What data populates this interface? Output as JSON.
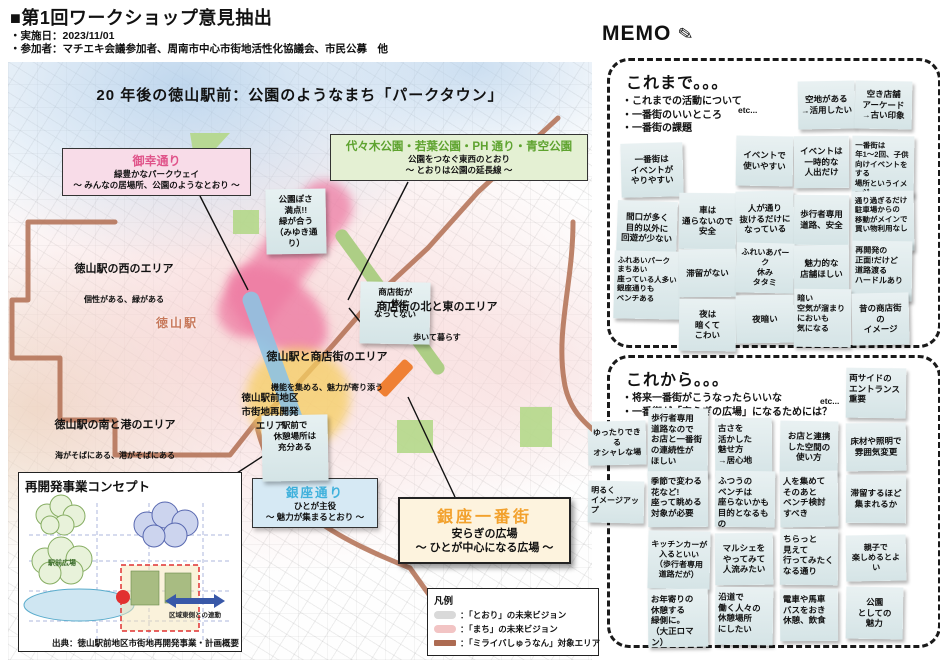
{
  "header": {
    "title": "■第1回ワークショップ意見抽出",
    "date_line": "・実施日：2023/11/01",
    "participants_line": "・参加者：マチエキ会議参加者、周南市中心市街地活性化協議会、市民公募　他"
  },
  "map": {
    "vision_title": "20 年後の徳山駅前：公園のようなまち「パークタウン」",
    "station_label": "徳山駅",
    "callouts": {
      "miyuki": {
        "title": "御幸通り",
        "line1": "緑豊かなパークウェイ",
        "line2": "～ みんなの居場所、公園のようなとおり ～",
        "title_color": "#e0548a"
      },
      "parks": {
        "title": "代々木公園・若葉公園・PH 通り・青空公園",
        "line1": "公園をつなぐ東西のとおり",
        "line2": "～ とおりは公園の延長線 ～",
        "title_color": "#5ea32f"
      },
      "ginza_street": {
        "title": "銀座通り",
        "line1": "ひとが主役",
        "line2": "～ 魅力が集まるとおり ～",
        "title_color": "#3fb1dc"
      },
      "ginza_ichibangai": {
        "title": "銀座一番街",
        "line1": "安らぎの広場",
        "line2": "～ ひとが中心になる広場 ～",
        "title_color": "#f2a12d"
      }
    },
    "sticky_notes": [
      {
        "t": "公園ぽさ\n満点!!\n緑が合う\n（みゆき通り）",
        "x": 258,
        "y": 127,
        "w": 52,
        "h": 50,
        "r": -1
      },
      {
        "t": "商店街が\n一体に\nなってない",
        "x": 352,
        "y": 220,
        "w": 62,
        "h": 52,
        "r": 1
      },
      {
        "t": "駅前で\n休憩場所は\n充分ある",
        "x": 254,
        "y": 353,
        "w": 58,
        "h": 56,
        "r": -1
      }
    ],
    "area_labels": [
      {
        "title": "徳山駅の西のエリア",
        "sub": "個性がある、緑がある"
      },
      {
        "title": "商店街の北と東のエリア",
        "sub": "歩いて暮らす"
      },
      {
        "title": "徳山駅と商店街のエリア",
        "sub": "機能を集める、魅力が寄り添う"
      },
      {
        "title": "徳山駅前地区\n市街地再開発\nエリア",
        "sub": ""
      },
      {
        "title": "徳山駅の南と港のエリア",
        "sub": "海がそばにある、港がそばにある"
      }
    ],
    "legend": {
      "title": "凡例",
      "items": [
        {
          "label": "：「とおり」の未来ビジョン",
          "color": "#d9d9d9"
        },
        {
          "label": "：「まち」の未来ビジョン",
          "color": "#f2c4c4"
        },
        {
          "label": "：「ミライバしゅうなん」対象エリア",
          "color": "#ad6b52"
        }
      ]
    },
    "inset": {
      "title": "再開発事業コンセプト",
      "labels": [
        "駅前広場",
        "区域東側との連動"
      ],
      "caption": "出典：徳山駅前地区市街地再開発事業・計画概要"
    }
  },
  "memo": {
    "title": "MEMO",
    "pencil_icon": "✎",
    "sections": [
      {
        "heading": "これまで。。。",
        "bullets": "・これまでの活動について\n・一番街のいいところ\n・一番街の課題",
        "etc": "etc...",
        "notes": [
          {
            "t": "空地がある\n→活用したい",
            "x": 188,
            "y": 20,
            "w": 57,
            "h": 48,
            "r": -1,
            "a": "c"
          },
          {
            "t": "空き店舗\nアーケード\n→古い印象",
            "x": 245,
            "y": 20,
            "w": 57,
            "h": 48,
            "r": 1,
            "a": "c"
          },
          {
            "t": "一番街は\nイベントが\nやりやすい",
            "x": 11,
            "y": 82,
            "w": 62,
            "h": 54,
            "r": -1.5,
            "a": "c"
          },
          {
            "t": "イベントで\n使いやすい",
            "x": 126,
            "y": 75,
            "w": 57,
            "h": 50,
            "r": 1,
            "a": "c"
          },
          {
            "t": "イベントは\n一時的な\n人出だけ",
            "x": 184,
            "y": 75,
            "w": 55,
            "h": 52,
            "r": -0.5,
            "a": "c"
          },
          {
            "t": "一番街は\n年1～2回、子供\n向けイベントをする\n場所というイメージ",
            "x": 242,
            "y": 75,
            "w": 62,
            "h": 60,
            "r": 0.8,
            "a": "l",
            "fs": 7.5
          },
          {
            "t": "間口が多く\n目的以外に\n回遊が少ない",
            "x": 7,
            "y": 140,
            "w": 60,
            "h": 54,
            "r": 2,
            "a": "c"
          },
          {
            "t": "車は\n通らないので\n安全",
            "x": 69,
            "y": 132,
            "w": 57,
            "h": 56,
            "r": 0.6,
            "a": "c"
          },
          {
            "t": "人が通り\n抜けるだけに\nなっている",
            "x": 126,
            "y": 130,
            "w": 58,
            "h": 56,
            "r": -1.2,
            "a": "c"
          },
          {
            "t": "歩行者専用\n道路、安全",
            "x": 184,
            "y": 134,
            "w": 55,
            "h": 50,
            "r": 0.5,
            "a": "c"
          },
          {
            "t": "通り過ぎるだけ\n駐車場からの\n移動がメインで\n買い物利用なし",
            "x": 242,
            "y": 130,
            "w": 62,
            "h": 60,
            "r": -0.8,
            "a": "l",
            "fs": 7.5
          },
          {
            "t": "ふれあいパーク\nまちあい\n座っている人多い\n銀座通りも\nベンチある",
            "x": 4,
            "y": 190,
            "w": 66,
            "h": 68,
            "r": 1.2,
            "a": "l",
            "fs": 7.5
          },
          {
            "t": "滞留がない",
            "x": 69,
            "y": 188,
            "w": 57,
            "h": 48,
            "r": -0.6,
            "a": "c"
          },
          {
            "t": "ふれいあパーク\n休み\nタタミ",
            "x": 126,
            "y": 182,
            "w": 58,
            "h": 50,
            "r": 1.4,
            "a": "c",
            "fs": 8
          },
          {
            "t": "魅力的な\n店舗ほしい",
            "x": 184,
            "y": 184,
            "w": 55,
            "h": 48,
            "r": -0.4,
            "a": "c"
          },
          {
            "t": "再開発の\n正面!だけど\n道路渡る\nハードルあり",
            "x": 242,
            "y": 180,
            "w": 60,
            "h": 60,
            "r": 0.8,
            "a": "l",
            "fs": 8
          },
          {
            "t": "夜は\n暗くて\nこわい",
            "x": 69,
            "y": 238,
            "w": 57,
            "h": 52,
            "r": 0.8,
            "a": "c"
          },
          {
            "t": "夜暗い",
            "x": 126,
            "y": 234,
            "w": 58,
            "h": 48,
            "r": -1,
            "a": "c"
          },
          {
            "t": "暗い\n空気が溜まり\nにおいも\n気になる",
            "x": 184,
            "y": 228,
            "w": 57,
            "h": 58,
            "r": 0.5,
            "a": "l",
            "fs": 8
          },
          {
            "t": "昔の商店街\nの\nイメージ",
            "x": 242,
            "y": 232,
            "w": 57,
            "h": 52,
            "r": -1.2,
            "a": "c"
          }
        ]
      },
      {
        "heading": "これから。。。",
        "bullets": "・将来一番街がこうなったらいいな\n・一番街が「安らぎの広場」になるためには？",
        "etc": "etc...",
        "notes": [
          {
            "t": "両サイドの\nエントランス\n重要",
            "x": 236,
            "y": 10,
            "w": 60,
            "h": 50,
            "r": 0.8,
            "a": "l"
          },
          {
            "t": "ゆったりできる\nオシャレな場",
            "x": -22,
            "y": 63,
            "w": 58,
            "h": 44,
            "r": -1.2,
            "a": "c",
            "fs": 8
          },
          {
            "t": "歩行者専用\n道路なので\nお店と一番街\nの連続性が\nほしい",
            "x": 38,
            "y": 50,
            "w": 60,
            "h": 68,
            "r": 0.6,
            "a": "l"
          },
          {
            "t": "古さを\n活かした\n魅せ方\n→居心地",
            "x": 105,
            "y": 60,
            "w": 57,
            "h": 58,
            "r": -0.6,
            "a": "l"
          },
          {
            "t": "お店と連携\nした空間の\n使い方",
            "x": 170,
            "y": 63,
            "w": 58,
            "h": 52,
            "r": 0.9,
            "a": "c"
          },
          {
            "t": "床材や照明で\n雰囲気変更",
            "x": 236,
            "y": 65,
            "w": 60,
            "h": 48,
            "r": -0.8,
            "a": "c"
          },
          {
            "t": "明るく\nイメージアップ",
            "x": -22,
            "y": 123,
            "w": 56,
            "h": 42,
            "r": 1,
            "a": "l",
            "fs": 8
          },
          {
            "t": "季節で変わる\n花など!\n座って眺める\n対象が必要",
            "x": 38,
            "y": 113,
            "w": 60,
            "h": 56,
            "r": -0.5,
            "a": "l"
          },
          {
            "t": "ふつうの\nベンチは\n座らないかも\n目的となるもの",
            "x": 105,
            "y": 113,
            "w": 60,
            "h": 56,
            "r": 0.7,
            "a": "l"
          },
          {
            "t": "人を集めて\nそのあと\nベンチ検討\nすべき",
            "x": 170,
            "y": 113,
            "w": 58,
            "h": 56,
            "r": -0.9,
            "a": "l"
          },
          {
            "t": "滞留するほど\n集まれるか",
            "x": 236,
            "y": 117,
            "w": 60,
            "h": 48,
            "r": 0.5,
            "a": "c"
          },
          {
            "t": "キッチンカーが\n入るといい\n（歩行者専用\n道路だが）",
            "x": 38,
            "y": 173,
            "w": 62,
            "h": 58,
            "r": 1.1,
            "a": "c",
            "fs": 8
          },
          {
            "t": "マルシェを\nやってみて\n人流みたい",
            "x": 105,
            "y": 175,
            "w": 58,
            "h": 52,
            "r": -0.7,
            "a": "c"
          },
          {
            "t": "ちらっと\n見えて\n行ってみたく\nなる通り",
            "x": 170,
            "y": 171,
            "w": 58,
            "h": 56,
            "r": 0.6,
            "a": "l"
          },
          {
            "t": "親子で\n楽しめるとよい",
            "x": 236,
            "y": 177,
            "w": 60,
            "h": 46,
            "r": -1,
            "a": "c",
            "fs": 8
          },
          {
            "t": "お年寄りの\n休憩する\n緑側に。\n（大正ロマン）",
            "x": 38,
            "y": 231,
            "w": 60,
            "h": 58,
            "r": -0.6,
            "a": "l"
          },
          {
            "t": "沿道で\n働く人々の\n休憩場所\nにしたい",
            "x": 105,
            "y": 229,
            "w": 58,
            "h": 58,
            "r": 0.8,
            "a": "l"
          },
          {
            "t": "電車や馬車\nバスをおき\n休憩、飲食",
            "x": 170,
            "y": 231,
            "w": 58,
            "h": 52,
            "r": -0.5,
            "a": "l"
          },
          {
            "t": "公園\nとしての\n魅力",
            "x": 236,
            "y": 229,
            "w": 57,
            "h": 52,
            "r": 0.9,
            "a": "c"
          }
        ]
      }
    ]
  }
}
